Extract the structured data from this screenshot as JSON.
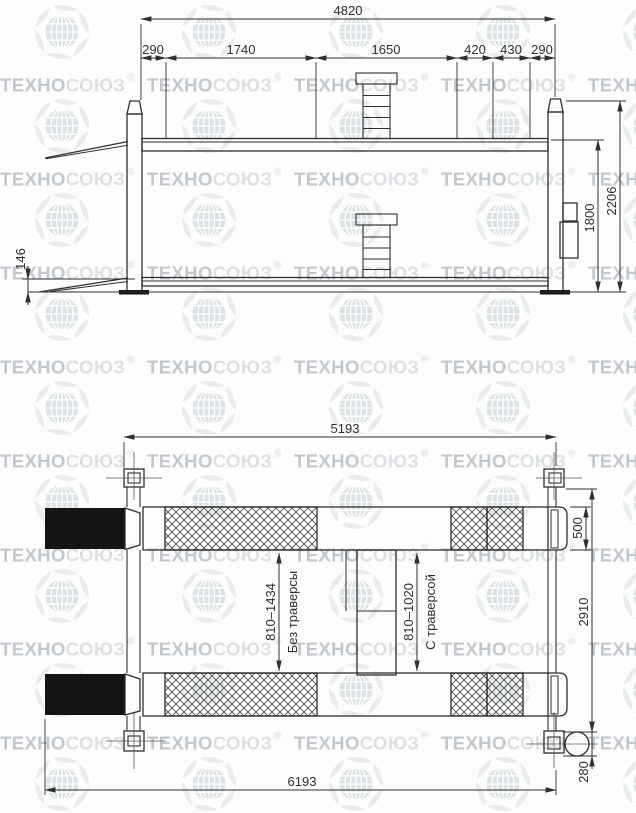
{
  "ink": "#2f2f2f",
  "watermark": {
    "brand_bold": "ТЕХНО",
    "brand_light": "СОЮЗ",
    "registered_mark": "®",
    "color_bold": "#c3c8cd",
    "color_light": "#dde1e4",
    "ornament_color": "#e9ecee",
    "globe_color": "#dde2e5"
  },
  "elevation": {
    "dim_total_length": "4820",
    "dim_segments": [
      "290",
      "1740",
      "1650",
      "420",
      "430",
      "290"
    ],
    "dim_total_height": "2206",
    "dim_lift_height": "1800",
    "dim_lowered_height": "146"
  },
  "plan": {
    "dim_frame_length": "5193",
    "dim_overall_length": "6193",
    "dim_runway_width": "500",
    "dim_frame_width": "2910",
    "dim_motor": "280",
    "dim_range_no_traverse": "810–1434",
    "label_no_traverse": "Без траверсы",
    "dim_range_traverse": "810–1020",
    "label_traverse": "С траверсой"
  }
}
